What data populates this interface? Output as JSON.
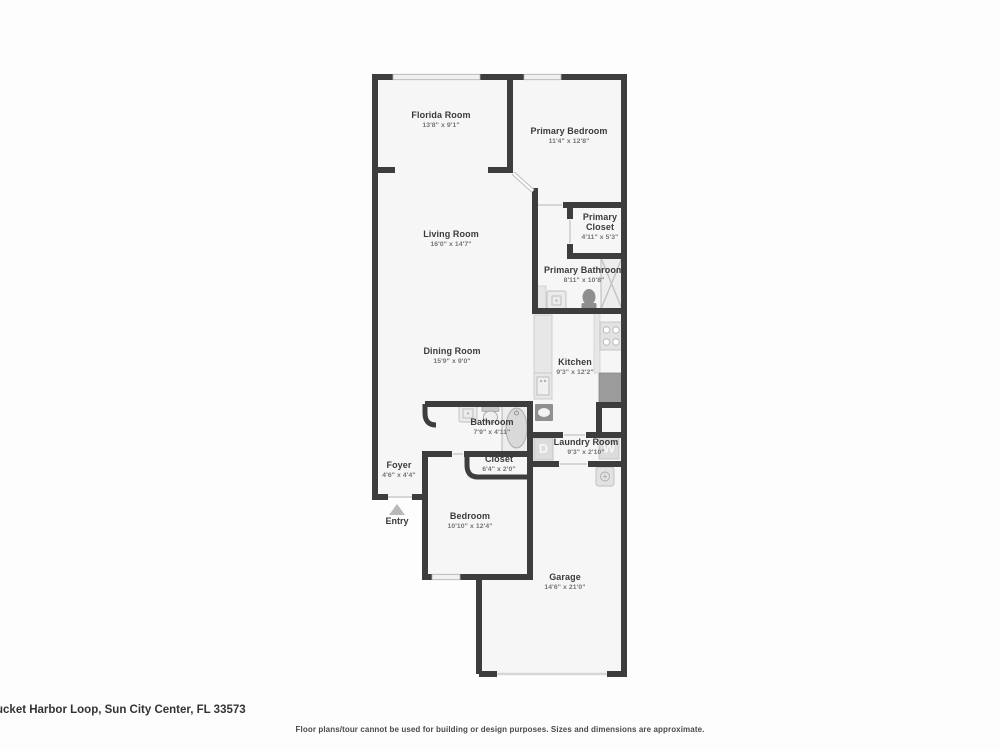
{
  "plan": {
    "rooms": [
      {
        "name": "Florida Room",
        "dims": "13'8\" x 9'1\""
      },
      {
        "name": "Primary Bedroom",
        "dims": "11'4\" x 12'8\""
      },
      {
        "name": "Living Room",
        "dims": "16'0\" x 14'7\""
      },
      {
        "name": "Primary Closet",
        "dims": "4'11\" x 5'3\""
      },
      {
        "name": "Primary Bathroom",
        "dims": "8'11\" x 10'8\""
      },
      {
        "name": "Dining Room",
        "dims": "15'9\" x 9'0\""
      },
      {
        "name": "Kitchen",
        "dims": "9'3\" x 12'2\""
      },
      {
        "name": "Bathroom",
        "dims": "7'9\" x 4'11\""
      },
      {
        "name": "Laundry Room",
        "dims": "9'3\" x 2'10\""
      },
      {
        "name": "Closet",
        "dims": "6'4\" x 2'0\""
      },
      {
        "name": "Foyer",
        "dims": "4'6\" x 4'4\""
      },
      {
        "name": "Bedroom",
        "dims": "10'10\" x 12'4\""
      },
      {
        "name": "Garage",
        "dims": "14'6\" x 21'0\""
      }
    ],
    "entry_label": "Entry",
    "appliances": {
      "dryer": "D",
      "washer": "W"
    }
  },
  "footer": {
    "address": "ucket Harbor Loop, Sun City Center, FL 33573",
    "disclaimer": "Floor plans/tour cannot be used for building or design purposes. Sizes and dimensions are approximate."
  },
  "colors": {
    "wall": "#3d3d3d",
    "room_fill": "#f6f6f6",
    "fixture_light": "#e5e5e5",
    "fixture_dark": "#949494",
    "window": "#f0f0f0"
  }
}
